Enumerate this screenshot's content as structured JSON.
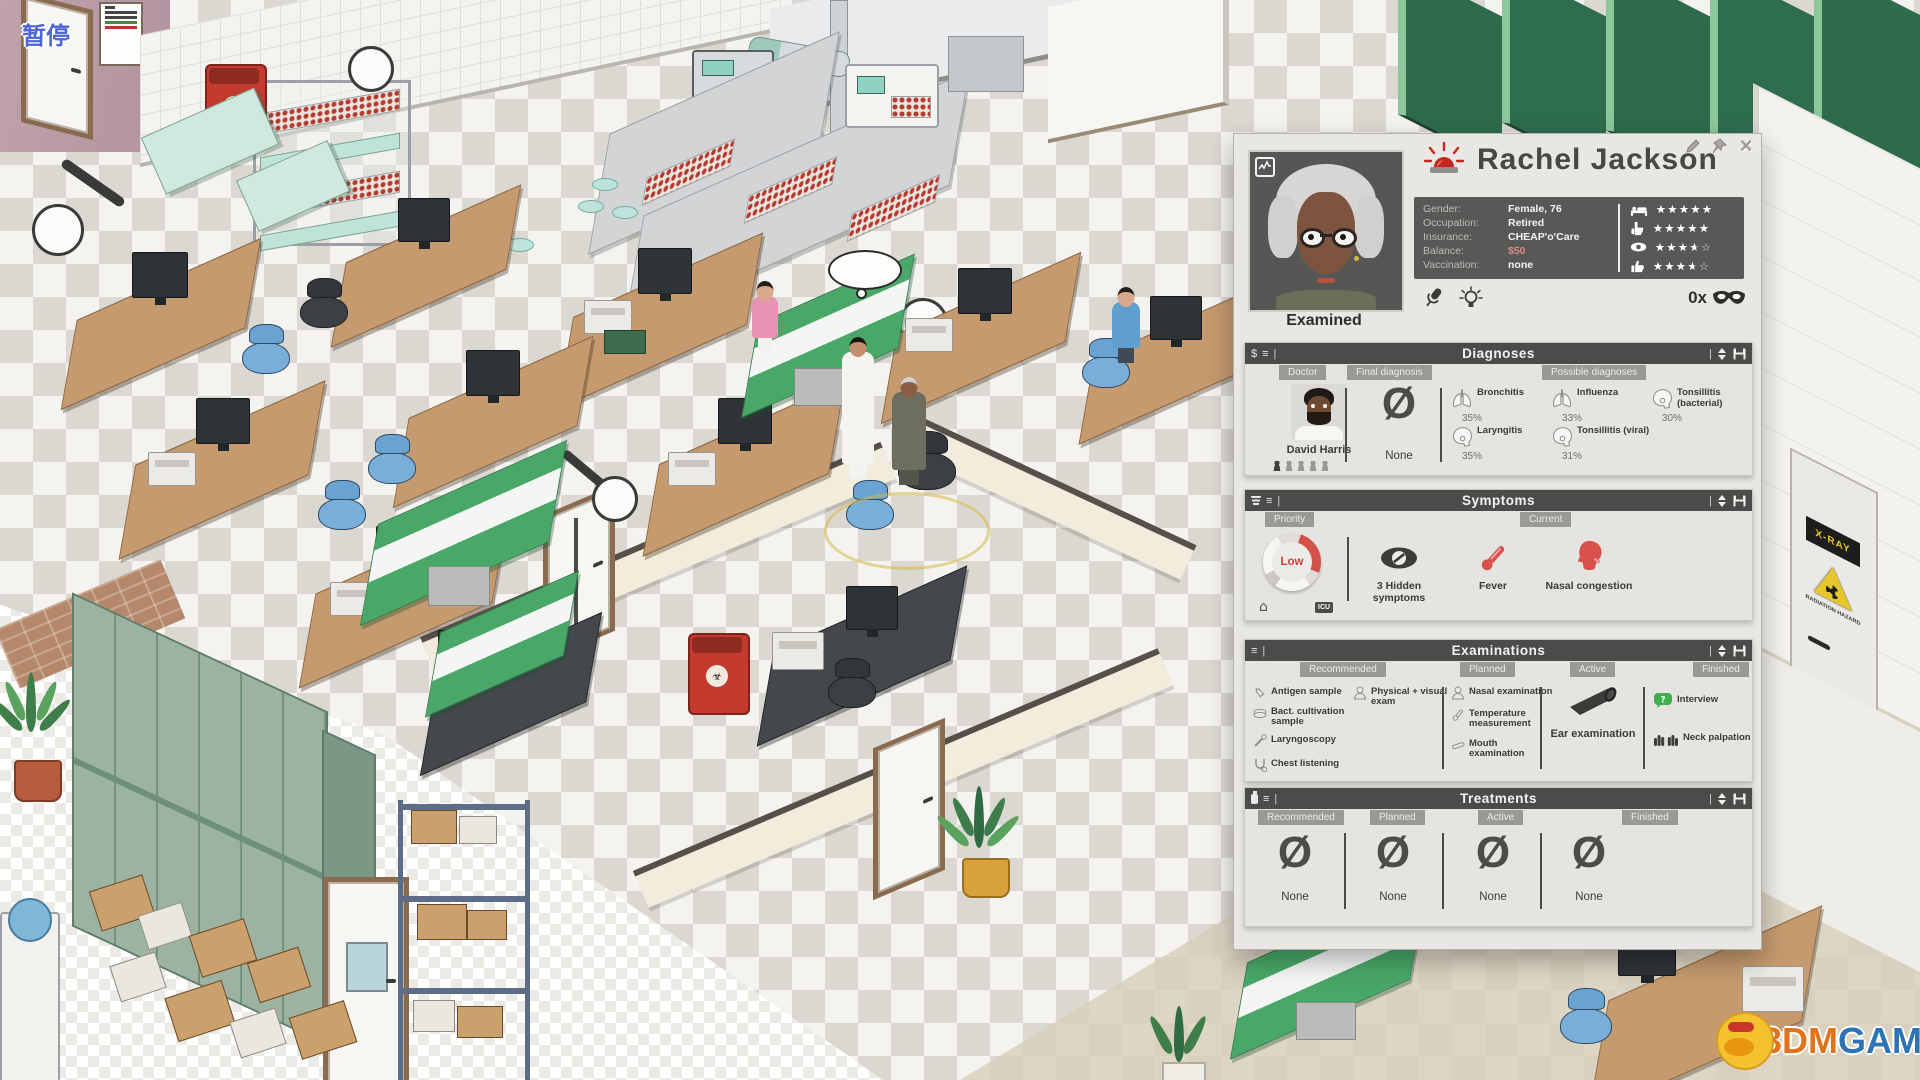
{
  "hud": {
    "pause_label": "暂停"
  },
  "watermark": {
    "part1": "3DM",
    "part2": "GAME"
  },
  "scene": {
    "xray_door_sign": "X-RAY",
    "radiation_text": "RADIATION HAZARD"
  },
  "icons": {
    "dollar": "$",
    "list": "≡",
    "pipe": "|",
    "close": "×",
    "home": "⌂",
    "icu": "ICU",
    "none_symbol": "Ø",
    "mask_count_suffix": "x"
  },
  "panel": {
    "patient": {
      "name": "Rachel Jackson",
      "status": "Examined",
      "fields": [
        {
          "label": "Gender:",
          "value": "Female, 76"
        },
        {
          "label": "Occupation:",
          "value": "Retired"
        },
        {
          "label": "Insurance:",
          "value": "CHEAP'o'Care"
        },
        {
          "label": "Balance:",
          "value": "$50"
        },
        {
          "label": "Vaccination:",
          "value": "none"
        }
      ],
      "ratings": [
        {
          "icon": "bed-icon",
          "value": 5
        },
        {
          "icon": "hand-icon",
          "value": 5
        },
        {
          "icon": "eye-icon",
          "value": 3.5
        },
        {
          "icon": "thumbs-up-icon",
          "value": 3.5
        }
      ],
      "mask_count": "0x"
    },
    "diagnoses": {
      "title": "Diagnoses",
      "tabs": [
        "Doctor",
        "Final diagnosis",
        "Possible diagnoses"
      ],
      "doctor_name": "David Harris",
      "final": "None",
      "possible": [
        {
          "name": "Bronchitis",
          "prob": "35%",
          "icon": "lungs-icon"
        },
        {
          "name": "Influenza",
          "prob": "33%",
          "icon": "lungs-icon"
        },
        {
          "name": "Tonsillitis (bacterial)",
          "prob": "30%",
          "icon": "throat-icon"
        },
        {
          "name": "Laryngitis",
          "prob": "35%",
          "icon": "throat-icon"
        },
        {
          "name": "Tonsillitis (viral)",
          "prob": "31%",
          "icon": "throat-icon"
        }
      ]
    },
    "symptoms": {
      "title": "Symptoms",
      "tabs": [
        "Priority",
        "Current"
      ],
      "priority": "Low",
      "items": [
        {
          "name": "3 Hidden symptoms",
          "icon": "hidden-symptoms-icon"
        },
        {
          "name": "Fever",
          "icon": "thermometer-icon"
        },
        {
          "name": "Nasal congestion",
          "icon": "nasal-icon"
        }
      ]
    },
    "examinations": {
      "title": "Examinations",
      "tabs": [
        "Recommended",
        "Planned",
        "Active",
        "Finished"
      ],
      "recommended": [
        {
          "name": "Antigen sample",
          "icon": "syringe-icon"
        },
        {
          "name": "Bact. cultivation sample",
          "icon": "petri-icon"
        },
        {
          "name": "Laryngoscopy",
          "icon": "scope-icon"
        },
        {
          "name": "Chest listening",
          "icon": "stethoscope-icon"
        },
        {
          "name": "Physical + visual exam",
          "icon": "person-icon"
        }
      ],
      "planned": [
        {
          "name": "Nasal examination",
          "icon": "person-icon"
        },
        {
          "name": "Temperature measurement",
          "icon": "thermometer-small-icon"
        },
        {
          "name": "Mouth examination",
          "icon": "depressor-icon"
        }
      ],
      "active": [
        {
          "name": "Ear examination",
          "icon": "otoscope-icon"
        }
      ],
      "finished": [
        {
          "name": "Interview",
          "icon": "interview-icon"
        },
        {
          "name": "Neck palpation",
          "icon": "hands-icon"
        }
      ]
    },
    "treatments": {
      "title": "Treatments",
      "tabs": [
        "Recommended",
        "Planned",
        "Active",
        "Finished"
      ],
      "columns": [
        {
          "value": "None"
        },
        {
          "value": "None"
        },
        {
          "value": "None"
        },
        {
          "value": "None"
        }
      ]
    }
  }
}
